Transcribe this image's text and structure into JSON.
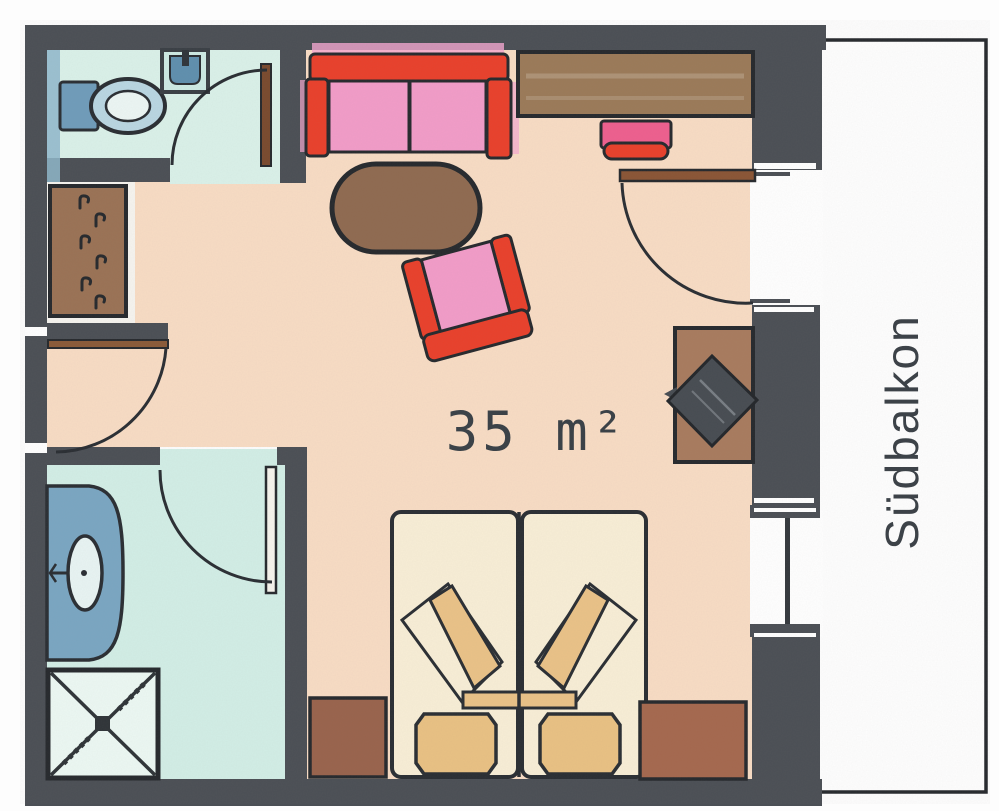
{
  "plan": {
    "labels": {
      "area": "35 m²",
      "balcony": "Südbalkon"
    },
    "colors": {
      "wall": "#4b4f55",
      "outline": "#26292d",
      "floor_main": "#f8dcc4",
      "floor_wc": "#daf1e9",
      "floor_bath": "#d2eee6",
      "floor_balcony": "#fefefe",
      "sofa_red": "#e9402b",
      "cushion_pink": "#f29cc8",
      "wood_brown": "#9a7255",
      "bed_cream": "#f8eed6",
      "bed_tan": "#eac287",
      "bath_blue": "#7aa6c2",
      "toilet_blue": "#6f9cba",
      "tv_dark": "#474c52",
      "label_text": "#394046"
    },
    "symbols": [
      {
        "name": "toilet-icon",
        "room": "wc"
      },
      {
        "name": "corner-sink-icon",
        "room": "wc"
      },
      {
        "name": "wardrobe-hangers-icon",
        "room": "entry-niche"
      },
      {
        "name": "washbasin-icon",
        "room": "bathroom"
      },
      {
        "name": "shower-icon",
        "room": "bathroom"
      },
      {
        "name": "sofa-icon",
        "room": "living-area"
      },
      {
        "name": "coffee-table-icon",
        "room": "living-area"
      },
      {
        "name": "armchair-icon",
        "room": "living-area"
      },
      {
        "name": "desk-icon",
        "room": "living-area"
      },
      {
        "name": "desk-chair-icon",
        "room": "living-area"
      },
      {
        "name": "tv-cabinet-icon",
        "room": "living-area"
      },
      {
        "name": "double-bed-icon",
        "room": "living-area"
      },
      {
        "name": "nightstand-icon",
        "room": "living-area"
      },
      {
        "name": "door-swing-icon",
        "count": 4
      },
      {
        "name": "window-icon",
        "room": "balcony-wall"
      }
    ]
  }
}
